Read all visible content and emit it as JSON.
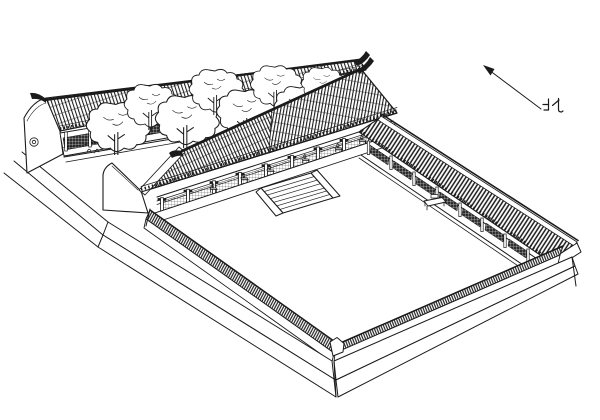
{
  "window": {
    "width": 600,
    "height": 420
  },
  "figure": {
    "type": "line-drawing",
    "projection": "axonometric-birds-eye",
    "subject": "courtyard-compound",
    "palette": {
      "ink": "#1b1b1b",
      "paper": "#ffffff"
    }
  },
  "north_indicator": {
    "label": "北",
    "icon": "north-arrow-icon"
  },
  "parts": {
    "rear_building": "rear-hall-curved-gable",
    "trees": "tree-row",
    "main_hall": "main-hall-veranda-steps",
    "east_gallery": "east-covered-corridor",
    "courtyard_wall": "perimeter-wall-tiled-coping",
    "platform": "stepped-base-platform",
    "courtyard": "open-courtyard"
  }
}
